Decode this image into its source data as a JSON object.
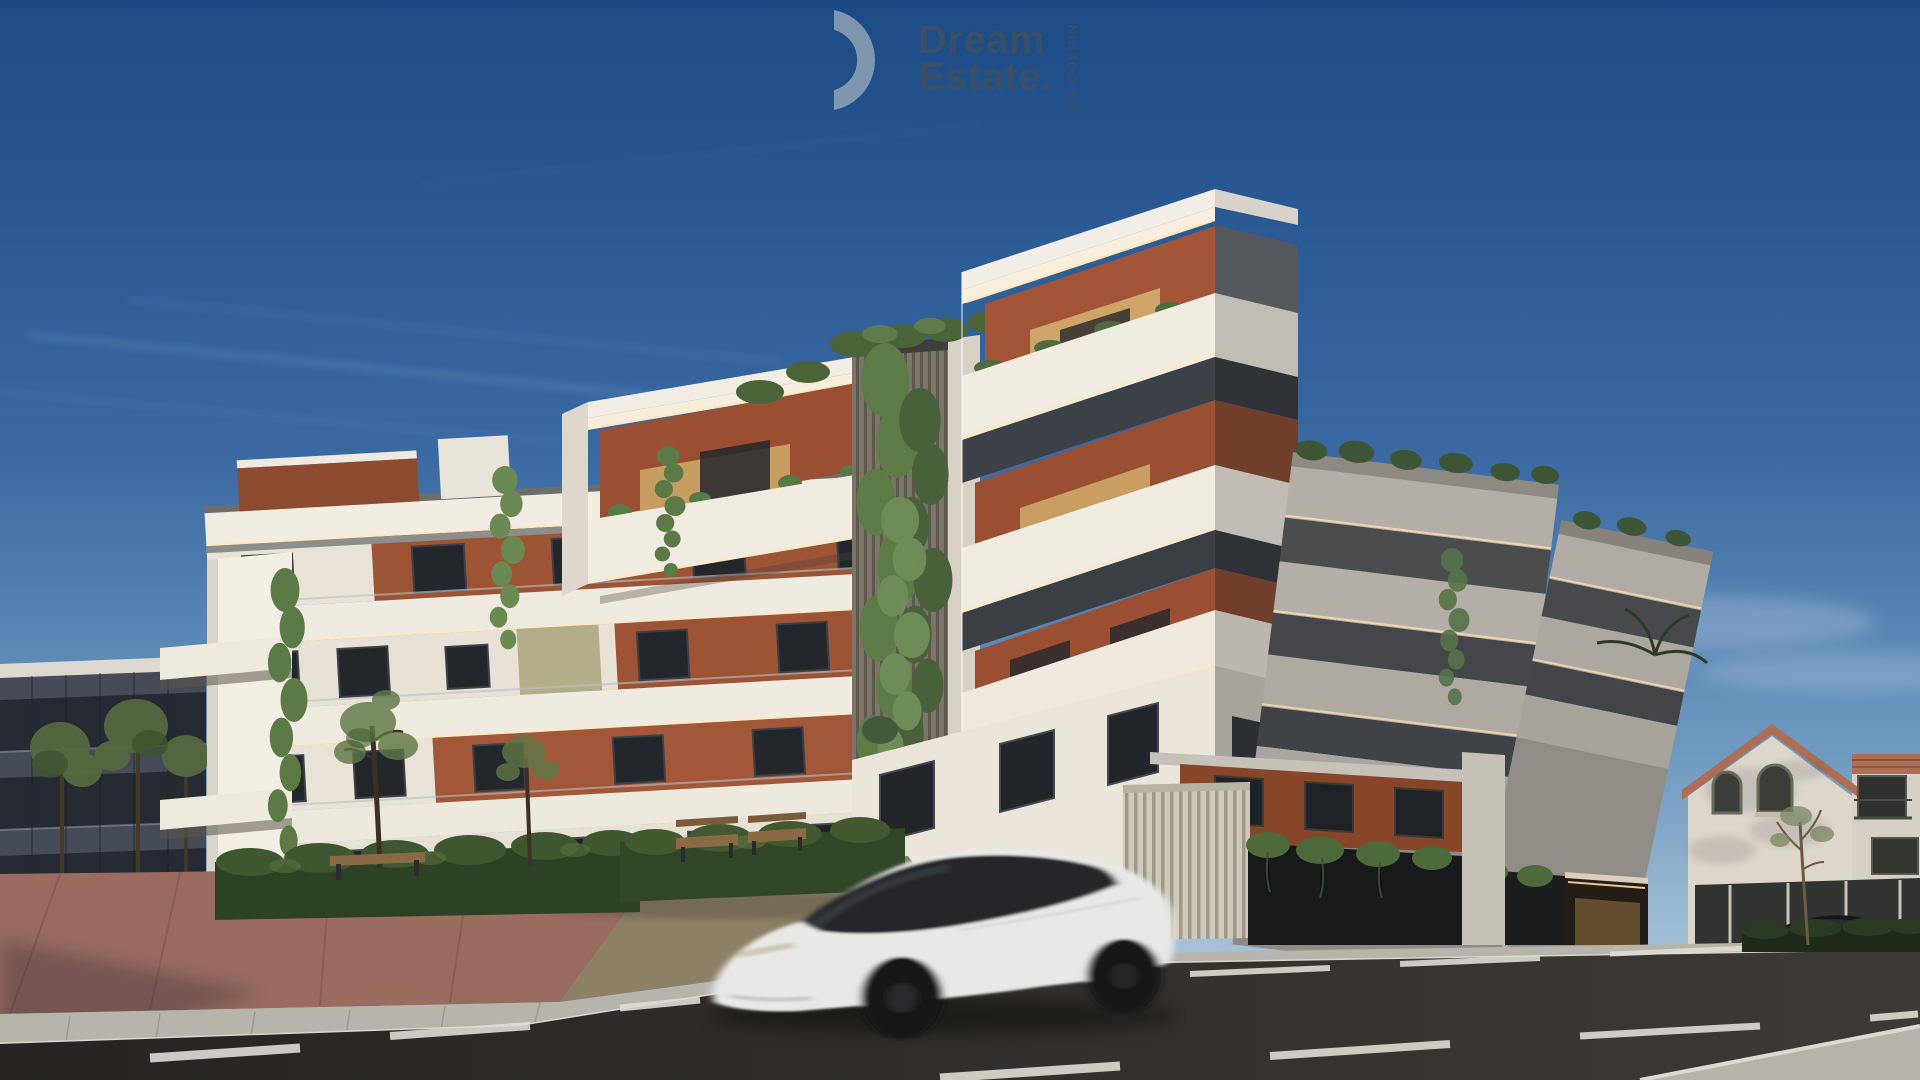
{
  "logo": {
    "icon": "half-circle-logo-icon",
    "line1": "Dream",
    "line2": "Estate.",
    "vertical_tagline": "BY COLPIN",
    "text_color": "#3d5166",
    "icon_color": "#93a7b8"
  },
  "scene": {
    "type": "3d-architectural-render",
    "subject": "modern four-storey apartment complex with cantilevered balconies, terracotta accents, LED soffit lighting, facade greenery and a white sedan passing on the street",
    "sky": {
      "top": "#1b4a85",
      "mid": "#3a69a2",
      "horizon": "#b9cfdd",
      "features": [
        "contrail-streaks-upper-left",
        "soft-clouds-right"
      ]
    },
    "palette": {
      "facade_white_sunlit": "#f0ebe1",
      "facade_white_shadow": "#b3aea6",
      "fascia_cream": "#f7efdc",
      "window_band_dark": "#343a41",
      "terracotta": "#9c5434",
      "terracotta_shadow": "#874628",
      "wood_panel": "#c89e62",
      "olive_panel": "#b3ad8a",
      "glass_rail": "#c7ced3",
      "greenery": "#5c7a45",
      "hedge_dark": "#2d4124",
      "led_strip": "#ffe9bd",
      "road_asphalt": "#332f2b",
      "sidewalk": "#b6b4ab",
      "plaza_brick": "#9a6c5f",
      "car_body": "#e8e8e6",
      "dark_glass_building": "#454c57",
      "spanish_roof_tile": "#ad6e55"
    },
    "elements": [
      {
        "name": "main-apartment-building",
        "label": "white contemporary apartment block with stacked balcony volumes"
      },
      {
        "name": "left-neighbor-building",
        "label": "dark glass building behind trees"
      },
      {
        "name": "spanish-style-building",
        "label": "white building with terracotta tiled roof and arched windows"
      },
      {
        "name": "white-sedan",
        "label": "white electric sedan driving past with motion blur"
      },
      {
        "name": "parked-dark-car",
        "label": "dark car parked behind low hedge at far right"
      },
      {
        "name": "street",
        "label": "asphalt road with dashed white lane markings"
      },
      {
        "name": "plaza",
        "label": "red brick pedestrian plaza with benches"
      },
      {
        "name": "landscaping",
        "label": "hedges, young trees and cascading ivy"
      }
    ]
  }
}
